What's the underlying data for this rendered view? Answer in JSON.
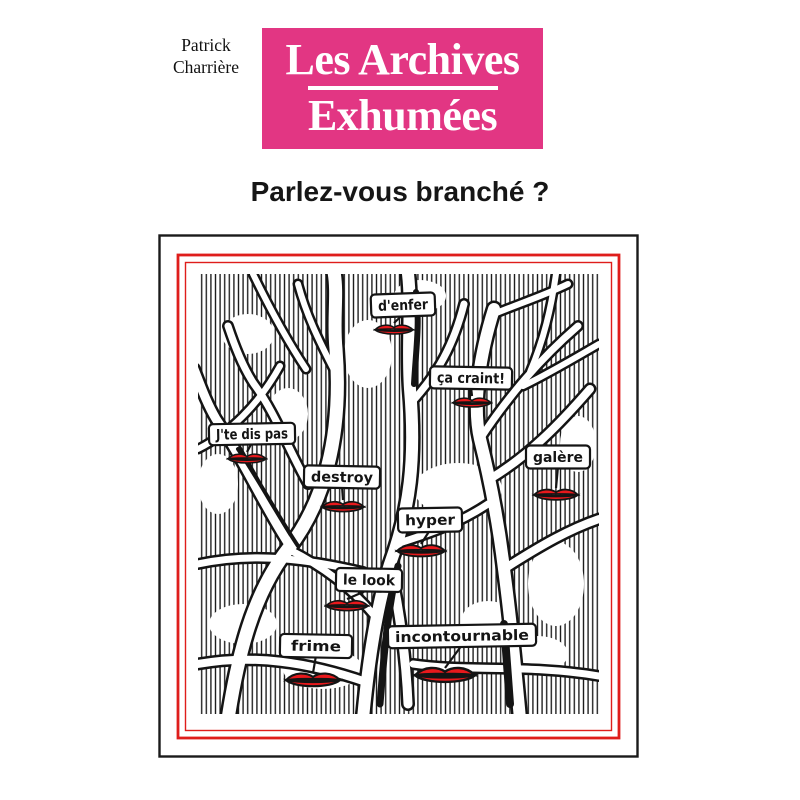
{
  "author": {
    "line1": "Patrick",
    "line2": "Charrière"
  },
  "title_block": {
    "line1": "Les Archives",
    "line2": "Exhumées",
    "bg_color": "#e23683",
    "text_color": "#ffffff"
  },
  "subtitle": "Parlez-vous branché ?",
  "illustration": {
    "frame_color": "#1a1a1a",
    "red_border_color": "#df1d1b",
    "lips_color": "#e8191c",
    "ink_color": "#141414",
    "labels": [
      {
        "text": "d'enfer",
        "x": 245,
        "y": 71,
        "w": 64,
        "h": 23,
        "rot": -2,
        "lips": {
          "x": 236,
          "y": 95,
          "w": 38
        }
      },
      {
        "text": "ça craint!",
        "x": 313,
        "y": 144,
        "w": 82,
        "h": 22,
        "rot": 1,
        "lips": {
          "x": 314,
          "y": 168,
          "w": 38
        }
      },
      {
        "text": "J'te dis pas",
        "x": 94,
        "y": 200,
        "w": 86,
        "h": 21,
        "rot": -1,
        "lips": {
          "x": 89,
          "y": 224,
          "w": 38
        }
      },
      {
        "text": "destroy",
        "x": 184,
        "y": 243,
        "w": 76,
        "h": 22,
        "rot": 1,
        "lips": {
          "x": 185,
          "y": 272,
          "w": 42
        }
      },
      {
        "text": "galère",
        "x": 400,
        "y": 223,
        "w": 64,
        "h": 23,
        "rot": 0,
        "lips": {
          "x": 398,
          "y": 260,
          "w": 44
        }
      },
      {
        "text": "hyper",
        "x": 272,
        "y": 286,
        "w": 64,
        "h": 24,
        "rot": -1,
        "lips": {
          "x": 263,
          "y": 316,
          "w": 48
        }
      },
      {
        "text": "le look",
        "x": 211,
        "y": 346,
        "w": 66,
        "h": 23,
        "rot": 1,
        "lips": {
          "x": 189,
          "y": 371,
          "w": 42
        }
      },
      {
        "text": "incontournable",
        "x": 304,
        "y": 402,
        "w": 148,
        "h": 22,
        "rot": -1,
        "lips": {
          "x": 287,
          "y": 440,
          "w": 60
        }
      },
      {
        "text": "frime",
        "x": 158,
        "y": 412,
        "w": 72,
        "h": 23,
        "rot": 1,
        "lips": {
          "x": 155,
          "y": 445,
          "w": 54
        }
      }
    ]
  }
}
